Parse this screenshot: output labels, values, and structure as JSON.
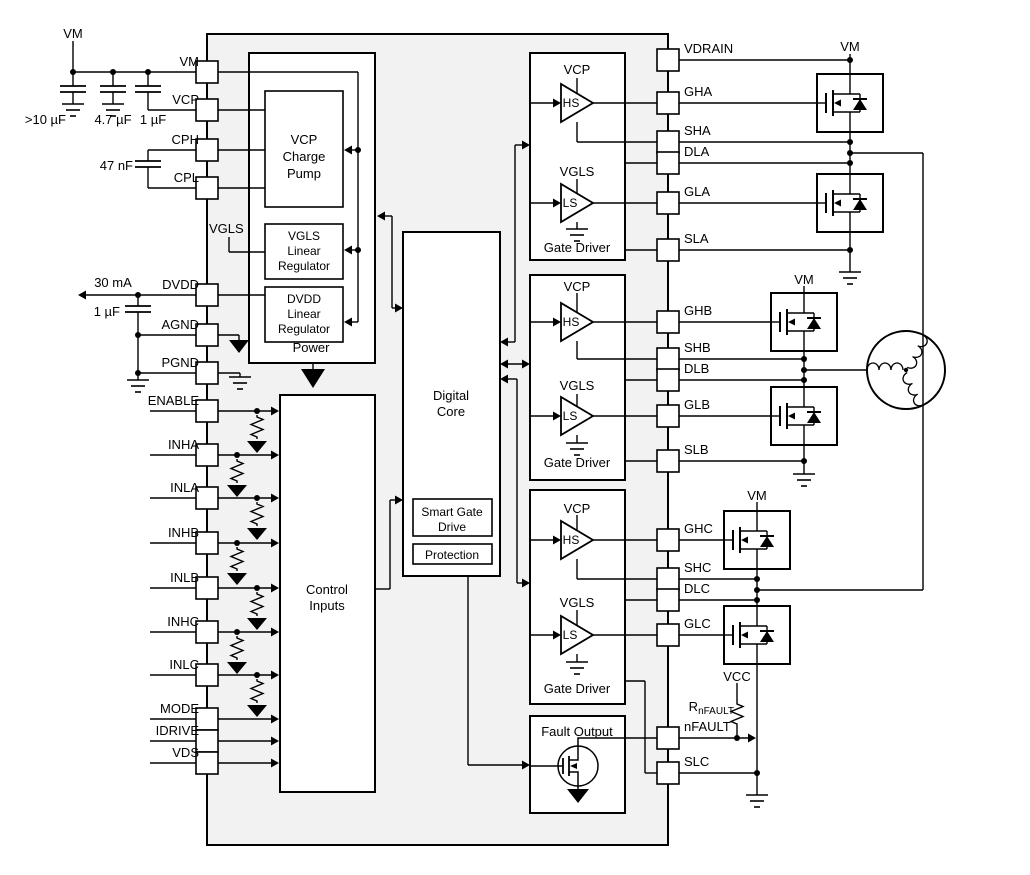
{
  "colors": {
    "ic_fill": "#f2f2f2",
    "stroke": "#000000"
  },
  "power_rail": {
    "vm": "VM",
    "cap_bulk": ">10 µF",
    "cap_47": "4.7 µF",
    "cap_1": "1 µF",
    "cap_cp": "47 nF"
  },
  "dvdd": {
    "current": "30 mA",
    "cap": "1 µF"
  },
  "left_pins": [
    "VM",
    "VCP",
    "CPH",
    "CPL",
    "DVDD",
    "AGND",
    "PGND",
    "ENABLE",
    "INHA",
    "INLA",
    "INHB",
    "INLB",
    "INHC",
    "INLC",
    "MODE",
    "IDRIVE",
    "VDS"
  ],
  "right_pins": [
    "VDRAIN",
    "GHA",
    "SHA",
    "DLA",
    "GLA",
    "SLA",
    "GHB",
    "SHB",
    "DLB",
    "GLB",
    "SLB",
    "GHC",
    "SHC",
    "DLC",
    "GLC",
    "nFAULT",
    "SLC"
  ],
  "internal": {
    "vgls_node": "VGLS",
    "power": "Power",
    "vcp_pump": [
      "VCP",
      "Charge",
      "Pump"
    ],
    "vgls_reg": [
      "VGLS",
      "Linear",
      "Regulator"
    ],
    "dvdd_reg": [
      "DVDD",
      "Linear",
      "Regulator"
    ],
    "digital_core": [
      "Digital",
      "Core"
    ],
    "smart_gate_drive": [
      "Smart Gate",
      "Drive"
    ],
    "protection": "Protection",
    "control_inputs": [
      "Control",
      "Inputs"
    ],
    "fault_output": "Fault Output",
    "gate_driver": {
      "vcp": "VCP",
      "hs": "HS",
      "vgls": "VGLS",
      "ls": "LS",
      "label": "Gate Driver"
    }
  },
  "external": {
    "vm": "VM",
    "vcc": "VCC",
    "rnfault_r": "R",
    "rnfault_sub": "nFAULT"
  }
}
